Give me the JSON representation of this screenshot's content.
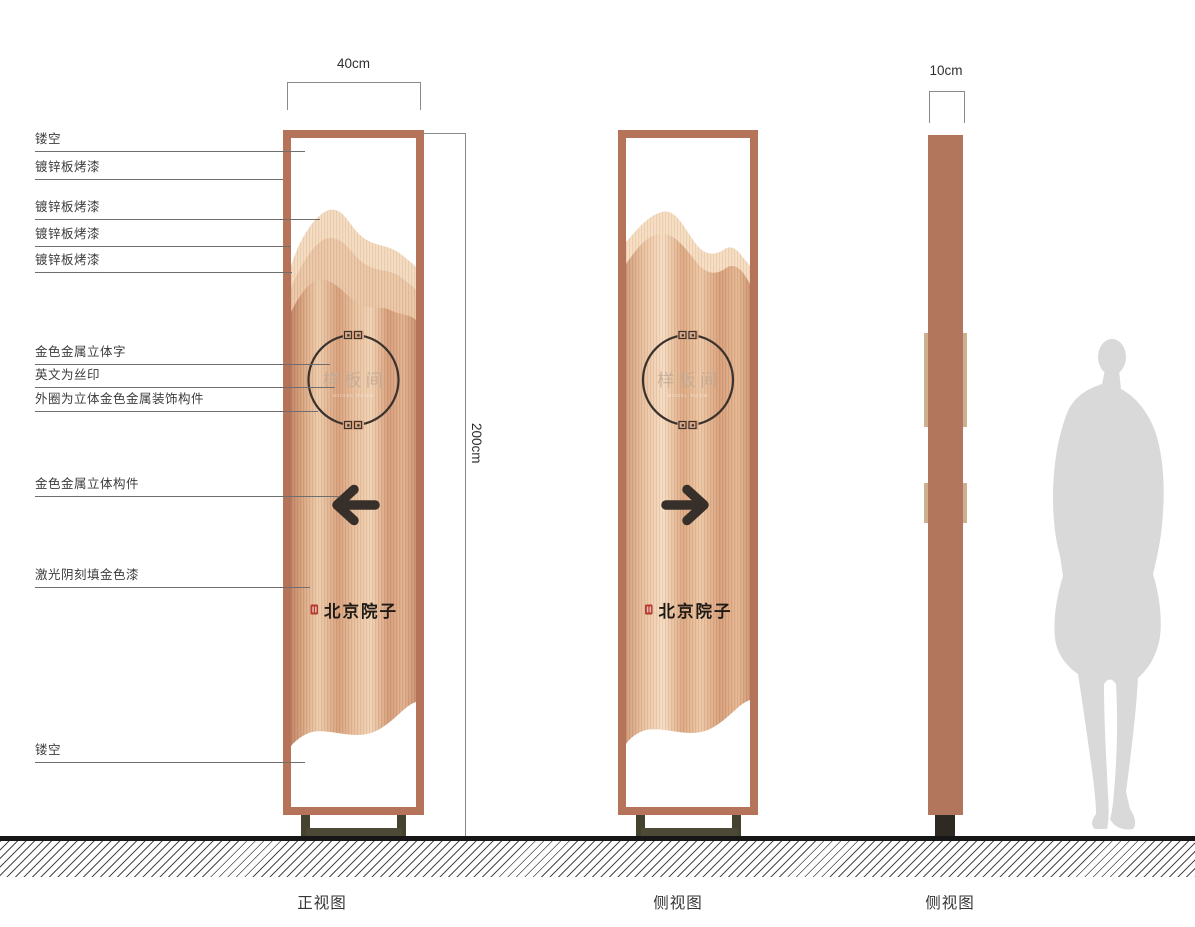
{
  "annotations": [
    {
      "label": "镂空"
    },
    {
      "label": "镀锌板烤漆"
    },
    {
      "label": "镀锌板烤漆"
    },
    {
      "label": "镀锌板烤漆"
    },
    {
      "label": "镀锌板烤漆"
    },
    {
      "label": "金色金属立体字"
    },
    {
      "label": "英文为丝印"
    },
    {
      "label": "外圈为立体金色金属装饰构件"
    },
    {
      "label": "金色金属立体构件"
    },
    {
      "label": "激光阴刻填金色漆"
    },
    {
      "label": "镂空"
    }
  ],
  "dimensions": {
    "front_width": "40cm",
    "height": "200cm",
    "side_width": "10cm"
  },
  "captions": {
    "front": "正视图",
    "middle": "侧视图",
    "right": "侧视图"
  },
  "sign": {
    "room_name": "样板间",
    "room_name_en": "MODEL ROOM",
    "brand_name": "北京院子"
  },
  "colors": {
    "frame_copper": "#b5735a",
    "panel_light": "#f0d2b4",
    "panel_dark": "#c8906d",
    "base_olive": "#45432f",
    "arrow_dark": "#37302a",
    "seal_red": "#b5392a",
    "silhouette_grey": "#d9d9d9"
  }
}
